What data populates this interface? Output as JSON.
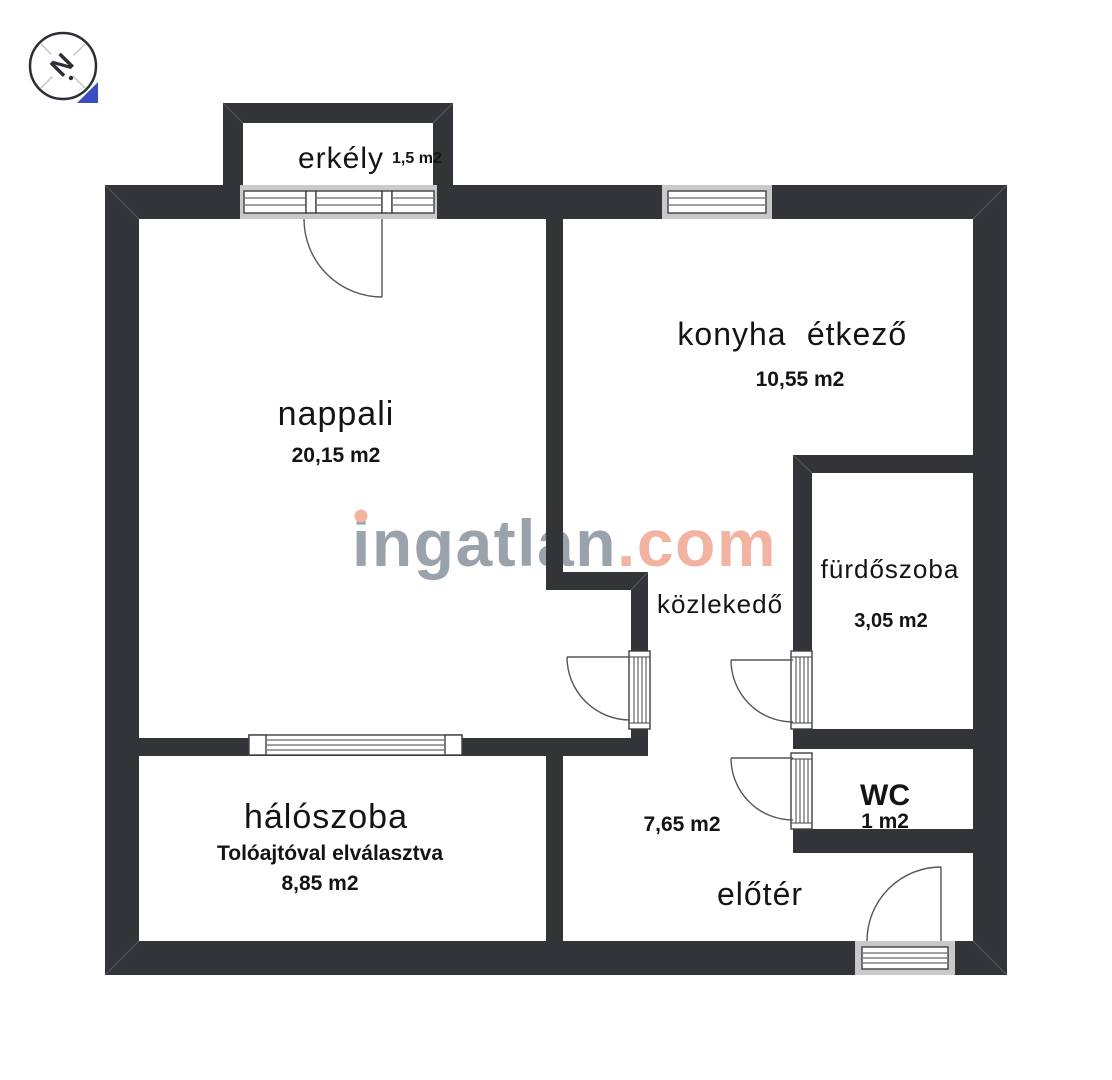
{
  "compass": {
    "letter": "N"
  },
  "watermark": {
    "name": "ingatlan",
    "tld": ".com"
  },
  "rooms": {
    "erkely": {
      "name": "erkély",
      "area": "1,5 m2"
    },
    "nappali": {
      "name": "nappali",
      "area": "20,15 m2"
    },
    "konyha": {
      "name": "konyha",
      "name2": "étkező",
      "area": "10,55 m2"
    },
    "furdoszoba": {
      "name": "fürdőszoba",
      "area": "3,05 m2"
    },
    "kozlekedo": {
      "name": "közlekedő"
    },
    "wc": {
      "name": "WC",
      "area": "1 m2"
    },
    "haloszoba": {
      "name": "hálószoba",
      "note": "Tolóajtóval elválasztva",
      "area": "8,85 m2"
    },
    "eloter": {
      "name": "előtér",
      "area": "7,65 m2"
    }
  },
  "colors": {
    "wall": "#333438",
    "window_band": "#c9c9c9",
    "frame_stroke": "#3f4045",
    "door_line": "#55565a",
    "watermark_gray": "#9aa2ab",
    "watermark_salmon": "#f2b3a0",
    "compass_blue": "#3a4dc0"
  }
}
